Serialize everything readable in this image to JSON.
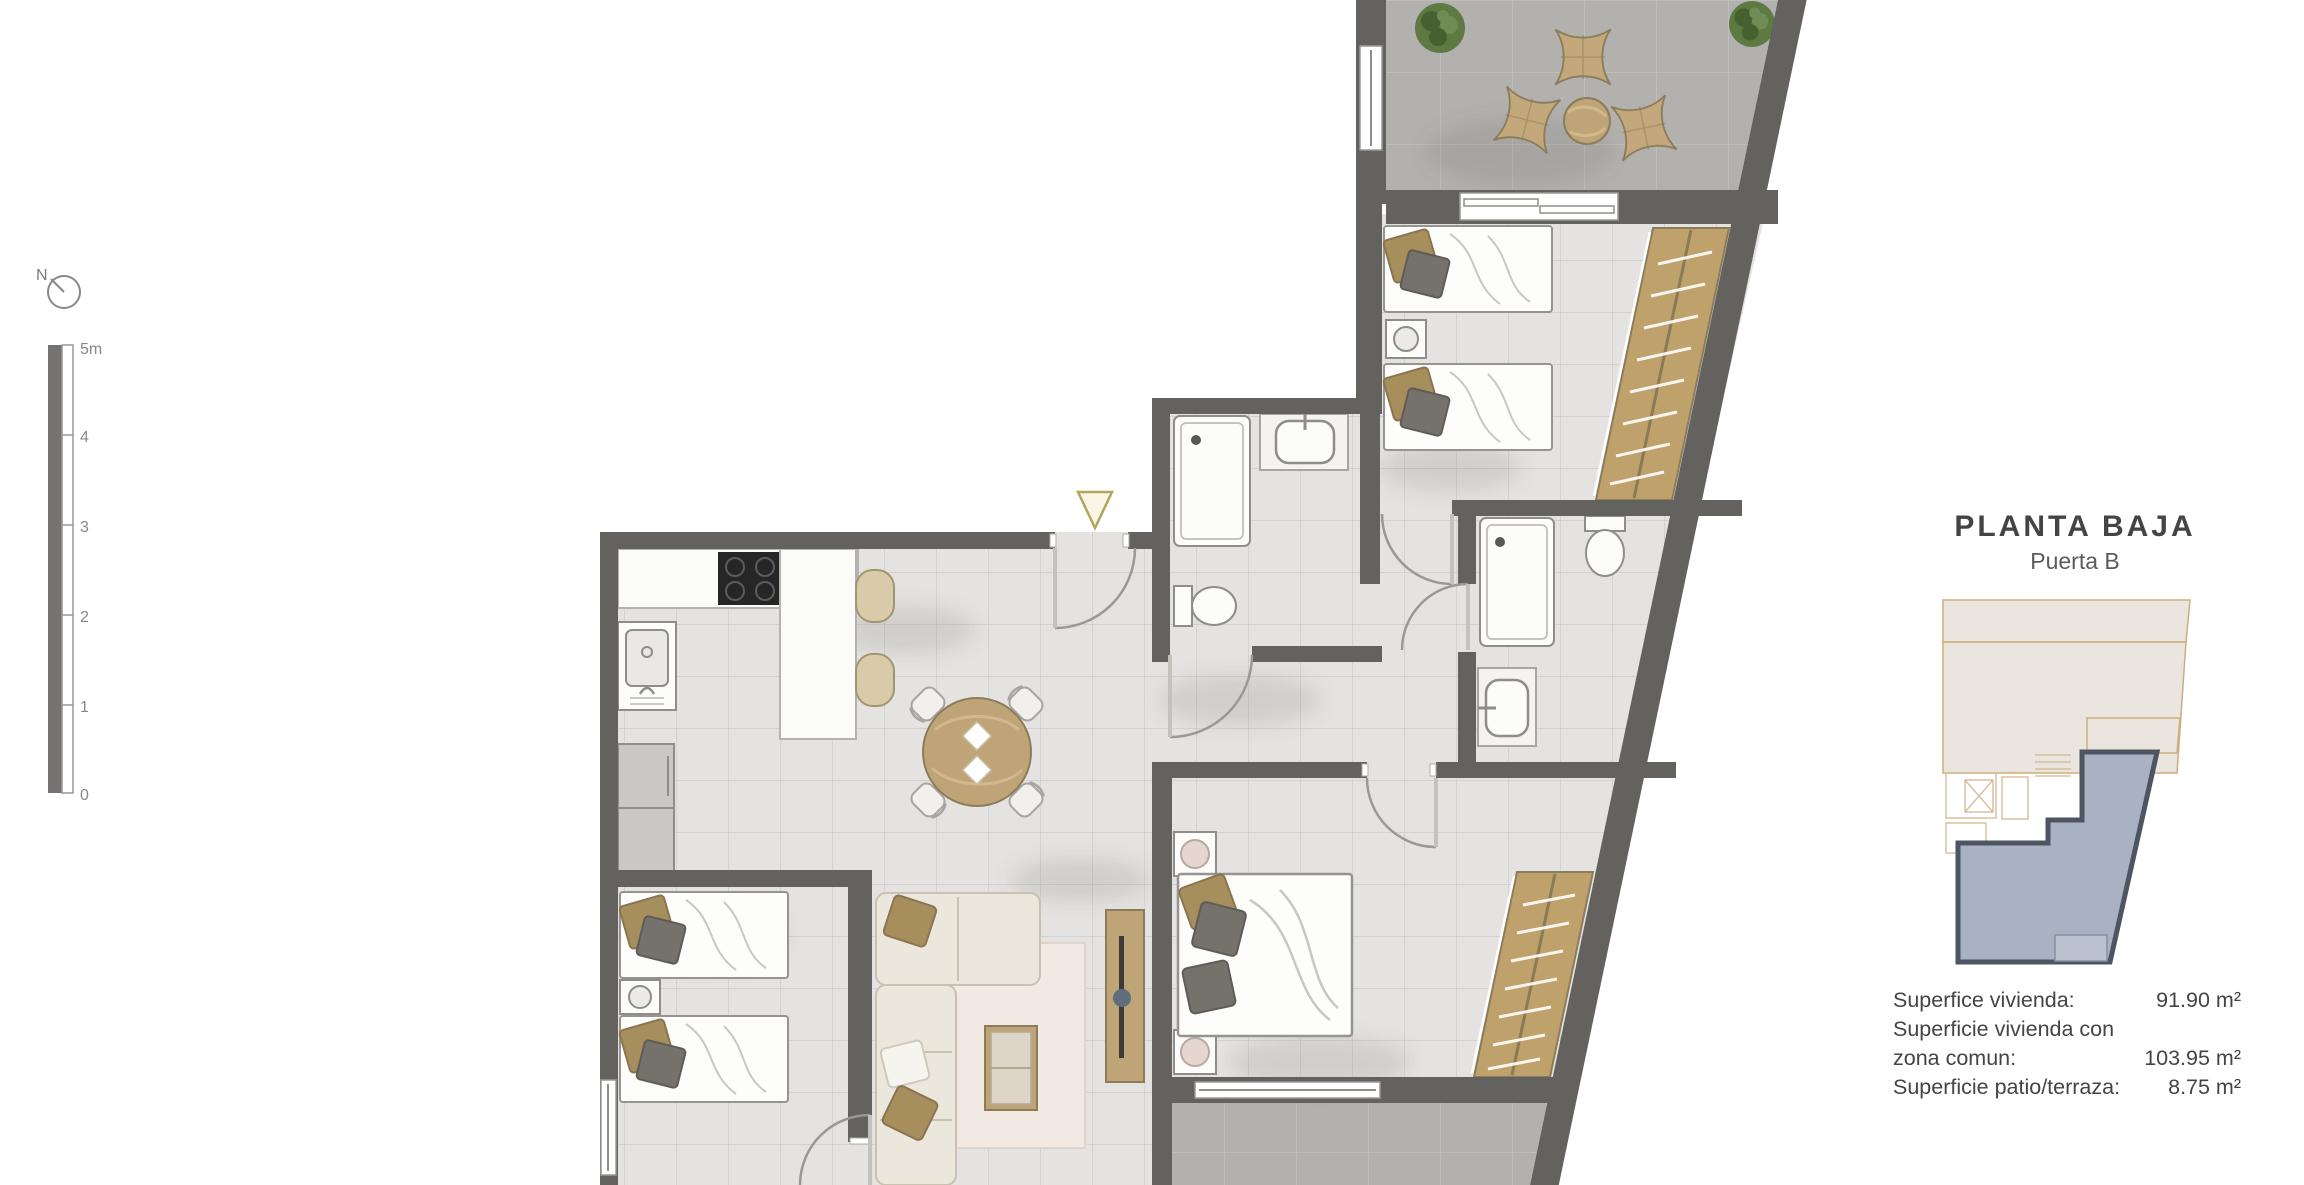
{
  "header": {
    "title": "PLANTA BAJA",
    "subtitle": "Puerta B"
  },
  "areas": {
    "rows": [
      {
        "label": "Superfice vivienda:",
        "value": "91.90 m²"
      },
      {
        "label": "Superficie vivienda con",
        "value": ""
      },
      {
        "label": "zona comun:",
        "value": "103.95 m²"
      },
      {
        "label": "Superficie patio/terraza:",
        "value": "8.75 m²"
      }
    ]
  },
  "scale_bar": {
    "labels": [
      "5m",
      "4",
      "3",
      "2",
      "1",
      "0"
    ]
  },
  "compass": {
    "label": "N"
  },
  "colors": {
    "wall": "#64625f",
    "floor": "#e4e3e1",
    "grout": "#cbc9c5",
    "terrace": "#b2b1ae",
    "terrace_grout": "#c2c1be",
    "wood": "#bfa477",
    "wood_dark": "#8d7c5a",
    "wardrobe": "#bfa26b",
    "fixture_stroke": "#8f8d89",
    "pillow_tan": "#a78e5d",
    "pillow_gray": "#75716b",
    "sofa": "#ece7dc",
    "sofa_stroke": "#c9c2b2",
    "rug": "#f2e9e3",
    "plant": "#5d7a43",
    "plant_dark": "#46602f",
    "arc": "#9a9894",
    "marker_fill": "#faf6e6",
    "marker_stroke": "#b6a45c",
    "unit_fill": "#a9b2c3",
    "unit_stroke": "#4d5462",
    "parcel": "#eae6df",
    "parcel_border": "#ccad7d",
    "text": "#454442",
    "text_soft": "#7c7a78"
  }
}
